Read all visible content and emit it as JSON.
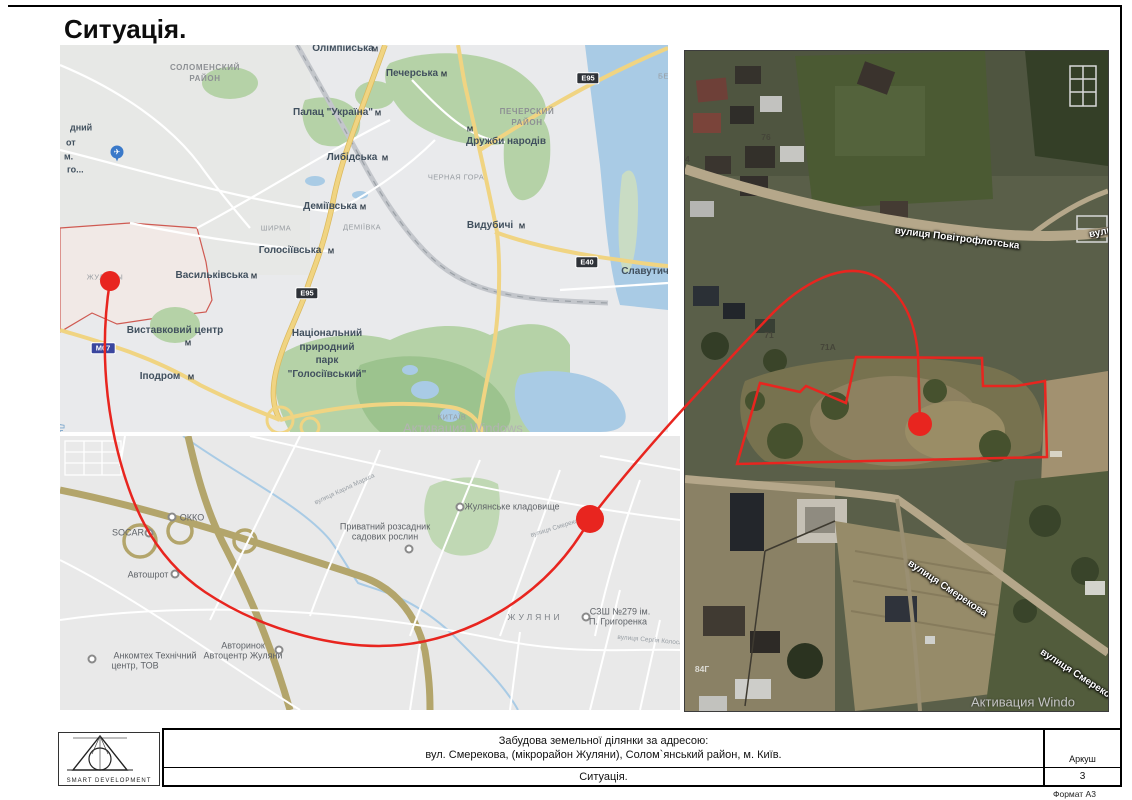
{
  "page": {
    "title": "Ситуація.",
    "format_label": "Формат А3"
  },
  "title_block": {
    "logo_text": "SMART DEVELOPMENT",
    "project_line1": "Забудова земельної ділянки за адресою:",
    "project_line2": "вул. Смерекова, (мікрорайон Жуляни), Солом`янський район, м. Київ.",
    "drawing_title": "Ситуація.",
    "sheet_label": "Аркуш",
    "sheet_number": "3"
  },
  "city_map": {
    "metro_icon": "М",
    "airport_icon": "✈",
    "watermark": "Активация Windows",
    "badges": [
      "E95",
      "E95",
      "E40",
      "M07"
    ],
    "labels": [
      "СОЛОМЕНСКИЙ",
      "РАЙОН",
      "Олімпійська",
      "Печерська",
      "Палац \"Україна\"",
      "ПЕЧЕРСКИЙ",
      "РАЙОН",
      "Дружби народів",
      "Либідська",
      "ЧЕРНАЯ ГОРА",
      "Деміївська",
      "ДЕМІЇВКА",
      "ШИРМА",
      "Голосіївська",
      "Васильківська",
      "ЖУЛЯНЫ",
      "Видубичі",
      "Славутич",
      "Днепр",
      "БЕР",
      "Виставковий центр",
      "Іподром",
      "Національний",
      "природний",
      "парк",
      "\"Голосіївський\"",
      "КИТАЇВ",
      "дний",
      "от",
      "м.",
      "го..."
    ]
  },
  "street_map": {
    "labels": [
      "ОККО",
      "SOCAR",
      "Автошрот",
      "Анкомтех Технічний",
      "центр, ТОВ",
      "Авторинок",
      "Автоцентр Жуляни",
      "СЗШ №279 ім.",
      "П. Григоренка",
      "Жулянське кладовище",
      "Приватний розсадник",
      "садових рослин",
      "ЖУЛЯНИ",
      "вулиця Карла Маркса",
      "вулиця Смерекова",
      "вулиця Сергія Колоса"
    ]
  },
  "satellite": {
    "labels": [
      "вулиця Повітрофлотська",
      "вули",
      "вулиця Смерекова",
      "вулиця Смереко",
      "76",
      "4",
      "71",
      "71А",
      "84Г",
      "Активация Windo"
    ]
  },
  "colors": {
    "red": "#e8251f",
    "red_boundary": "#cf5a52",
    "water": "#a9cbe5",
    "park": "#b5d2a7",
    "park_dark": "#9cc38e",
    "road_yellow": "#f0d482",
    "road_tan": "#b3a56b",
    "map_bg": "#e9eaec",
    "badge_dark": "#2e3238",
    "badge_blue": "#3a469e",
    "sat_road": "#b5a78a"
  }
}
